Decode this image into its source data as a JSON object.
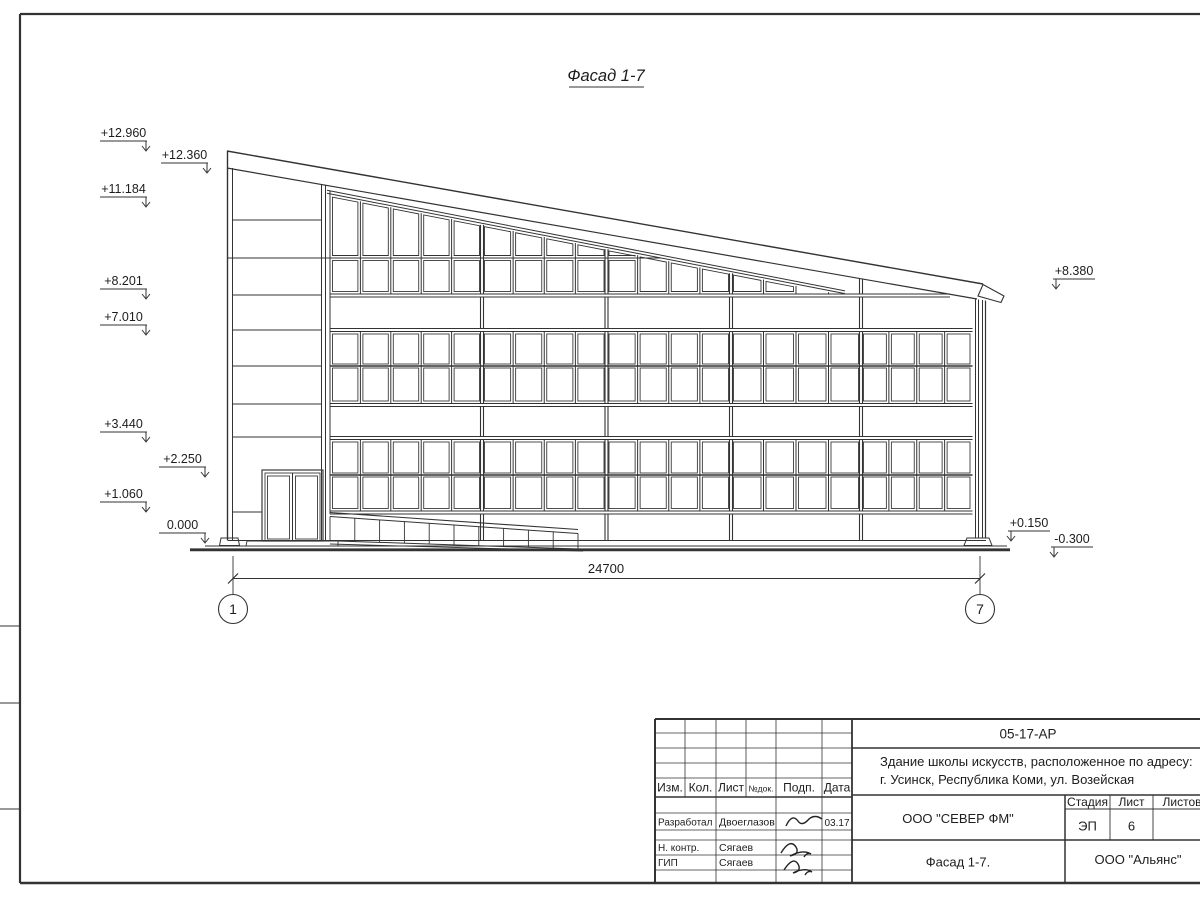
{
  "drawing": {
    "title": "Фасад 1-7",
    "dimension": "24700",
    "axes": {
      "left": "1",
      "right": "7"
    },
    "elevations": {
      "left": [
        "+12.960",
        "+12.360",
        "+11.184",
        "+8.201",
        "+7.010",
        "+3.440",
        "+2.250",
        "+1.060",
        "0.000"
      ],
      "right": [
        "+8.380",
        "+0.150",
        "-0.300"
      ]
    }
  },
  "title_block": {
    "doc_number": "05-17-АР",
    "project_line1": "Здание школы искусств, расположенное по адресу:",
    "project_line2": "г. Усинск, Республика Коми, ул. Возейская",
    "designer_org": "ООО \"СЕВЕР ФМ\"",
    "client_org": "ООО \"Альянс\"",
    "sheet_name": "Фасад 1-7.",
    "stage_label": "Стадия",
    "stage_value": "ЭП",
    "sheet_label": "Лист",
    "sheet_value": "6",
    "sheets_label": "Листов",
    "columns": [
      "Изм.",
      "Кол.",
      "Лист",
      "№док.",
      "Подп.",
      "Дата"
    ],
    "roles": [
      {
        "role": "Разработал",
        "name": "Двоеглазов",
        "date": "03.17"
      },
      {
        "role": "Н. контр.",
        "name": "Сягаев",
        "date": ""
      },
      {
        "role": "ГИП",
        "name": "Сягаев",
        "date": ""
      }
    ]
  }
}
